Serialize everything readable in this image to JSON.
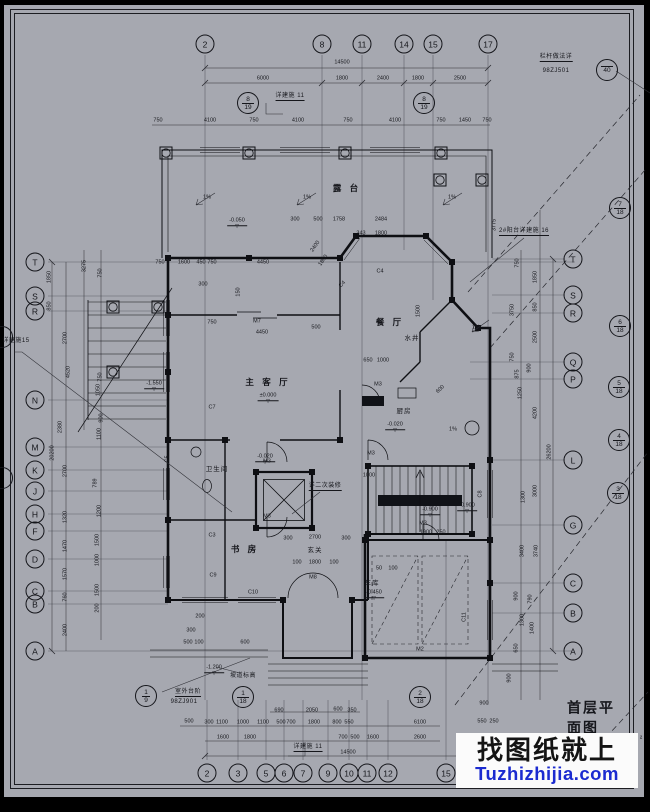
{
  "meta": {
    "sheet_title": "首层平面图",
    "area_fragment": "²",
    "bg_color": "#a6a8b0",
    "ink_color": "#15161b",
    "watermark_blue": "#1b2bd0"
  },
  "watermark": {
    "line1": "找图纸就上",
    "line2": "Tuzhizhijia.com"
  },
  "grid_bubbles": {
    "top": {
      "y": 44,
      "items": [
        {
          "x": 205,
          "label": "2"
        },
        {
          "x": 322,
          "label": "8"
        },
        {
          "x": 362,
          "label": "11"
        },
        {
          "x": 404,
          "label": "14"
        },
        {
          "x": 433,
          "label": "15"
        },
        {
          "x": 488,
          "label": "17"
        }
      ]
    },
    "bottom": {
      "y": 773,
      "items": [
        {
          "x": 207,
          "label": "2"
        },
        {
          "x": 238,
          "label": "3"
        },
        {
          "x": 266,
          "label": "5"
        },
        {
          "x": 284,
          "label": "6"
        },
        {
          "x": 303,
          "label": "7"
        },
        {
          "x": 328,
          "label": "9"
        },
        {
          "x": 349,
          "label": "10"
        },
        {
          "x": 367,
          "label": "11"
        },
        {
          "x": 388,
          "label": "12"
        },
        {
          "x": 446,
          "label": "15"
        }
      ]
    },
    "left": {
      "x": 35,
      "items": [
        {
          "y": 262,
          "label": "T"
        },
        {
          "y": 296,
          "label": "S"
        },
        {
          "y": 311,
          "label": "R"
        },
        {
          "y": 400,
          "label": "N"
        },
        {
          "y": 447,
          "label": "M"
        },
        {
          "y": 470,
          "label": "K"
        },
        {
          "y": 491,
          "label": "J"
        },
        {
          "y": 514,
          "label": "H"
        },
        {
          "y": 531,
          "label": "F"
        },
        {
          "y": 559,
          "label": "D"
        },
        {
          "y": 591,
          "label": "C"
        },
        {
          "y": 604,
          "label": "B"
        },
        {
          "y": 651,
          "label": "A"
        }
      ]
    },
    "right": {
      "x": 573,
      "items": [
        {
          "y": 259,
          "label": "T"
        },
        {
          "y": 295,
          "label": "S"
        },
        {
          "y": 313,
          "label": "R"
        },
        {
          "y": 362,
          "label": "Q"
        },
        {
          "y": 379,
          "label": "P"
        },
        {
          "y": 460,
          "label": "L"
        },
        {
          "y": 525,
          "label": "G"
        },
        {
          "y": 583,
          "label": "C"
        },
        {
          "y": 613,
          "label": "B"
        },
        {
          "y": 651,
          "label": "A"
        }
      ]
    }
  },
  "section_marks": [
    {
      "x": 620,
      "y": 208,
      "label": "7/18"
    },
    {
      "x": 620,
      "y": 326,
      "label": "6/18"
    },
    {
      "x": 619,
      "y": 387,
      "label": "5/18"
    },
    {
      "x": 619,
      "y": 440,
      "label": "4/18"
    },
    {
      "x": 618,
      "y": 493,
      "label": "3/18"
    },
    {
      "x": 146,
      "y": 696,
      "label": "1/9"
    },
    {
      "x": 243,
      "y": 697,
      "label": "1/18"
    },
    {
      "x": 420,
      "y": 697,
      "label": "2/18"
    },
    {
      "x": 248,
      "y": 103,
      "label": "8/19"
    },
    {
      "x": 424,
      "y": 103,
      "label": "8/19"
    },
    {
      "x": 607,
      "y": 70,
      "label": "/40"
    },
    {
      "x": 2,
      "y": 337,
      "label": ""
    },
    {
      "x": 2,
      "y": 478,
      "label": ""
    }
  ],
  "labels": [
    {
      "x": 556,
      "y": 58,
      "t": "栏杆做法详",
      "c": "nu"
    },
    {
      "x": 556,
      "y": 71,
      "t": "98ZJ501",
      "c": "note"
    },
    {
      "x": 290,
      "y": 97,
      "t": "详建施 11",
      "c": "nu"
    },
    {
      "x": 524,
      "y": 232,
      "t": "2#阳台详建施 16",
      "c": "nu"
    },
    {
      "x": 16,
      "y": 341,
      "t": "详建施15",
      "c": "note"
    },
    {
      "x": 325,
      "y": 487,
      "t": "详二次装修",
      "c": "nu"
    },
    {
      "x": 188,
      "y": 693,
      "t": "室外台阶",
      "c": "nu"
    },
    {
      "x": 184,
      "y": 702,
      "t": "98ZJ901",
      "c": "note"
    },
    {
      "x": 243,
      "y": 676,
      "t": "坡道标高",
      "c": "note"
    },
    {
      "x": 308,
      "y": 748,
      "t": "详建施 11",
      "c": "nu"
    },
    {
      "x": 347,
      "y": 188,
      "t": "露 台",
      "c": "room"
    },
    {
      "x": 268,
      "y": 382,
      "t": "主 客 厅",
      "c": "room"
    },
    {
      "x": 390,
      "y": 322,
      "t": "餐 厅",
      "c": "room"
    },
    {
      "x": 245,
      "y": 549,
      "t": "书 房",
      "c": "room"
    },
    {
      "x": 315,
      "y": 551,
      "t": "玄关",
      "c": "rs"
    },
    {
      "x": 217,
      "y": 470,
      "t": "卫生间",
      "c": "rs"
    },
    {
      "x": 372,
      "y": 584,
      "t": "车库",
      "c": "rs"
    },
    {
      "x": 404,
      "y": 412,
      "t": "厨房",
      "c": "rs"
    },
    {
      "x": 412,
      "y": 339,
      "t": "水井",
      "c": "rs"
    },
    {
      "x": 268,
      "y": 397,
      "t": "±0.000",
      "c": "elev"
    },
    {
      "x": 237,
      "y": 222,
      "t": "-0.050",
      "c": "elev"
    },
    {
      "x": 265,
      "y": 458,
      "t": "-0.020",
      "c": "elev"
    },
    {
      "x": 395,
      "y": 426,
      "t": "-0.020",
      "c": "elev"
    },
    {
      "x": 430,
      "y": 511,
      "t": "-0.900",
      "c": "elev"
    },
    {
      "x": 467,
      "y": 507,
      "t": "-0.900",
      "c": "elev"
    },
    {
      "x": 154,
      "y": 385,
      "t": "-1.550",
      "c": "elev"
    },
    {
      "x": 214,
      "y": 669,
      "t": "-1.200",
      "c": "elev"
    },
    {
      "x": 374,
      "y": 594,
      "t": "-0.450",
      "c": "elev"
    },
    {
      "x": 257,
      "y": 322,
      "t": "M7",
      "c": "tag"
    },
    {
      "x": 378,
      "y": 385,
      "t": "M3",
      "c": "tag"
    },
    {
      "x": 371,
      "y": 454,
      "t": "M3",
      "c": "tag"
    },
    {
      "x": 267,
      "y": 462,
      "t": "M3",
      "c": "tag"
    },
    {
      "x": 267,
      "y": 517,
      "t": "M3",
      "c": "tag"
    },
    {
      "x": 423,
      "y": 524,
      "t": "M3",
      "c": "tag"
    },
    {
      "x": 313,
      "y": 578,
      "t": "M8",
      "c": "tag"
    },
    {
      "x": 420,
      "y": 650,
      "t": "M2",
      "c": "tag"
    },
    {
      "x": 343,
      "y": 285,
      "t": "C4",
      "c": "tag",
      "r": -45
    },
    {
      "x": 380,
      "y": 272,
      "t": "C4",
      "c": "tag"
    },
    {
      "x": 212,
      "y": 408,
      "t": "C7",
      "c": "tag"
    },
    {
      "x": 168,
      "y": 459,
      "t": "C5",
      "c": "tag",
      "r": -90
    },
    {
      "x": 212,
      "y": 536,
      "t": "C3",
      "c": "tag"
    },
    {
      "x": 481,
      "y": 494,
      "t": "C8",
      "c": "tag",
      "r": -90
    },
    {
      "x": 213,
      "y": 576,
      "t": "C9",
      "c": "tag"
    },
    {
      "x": 253,
      "y": 593,
      "t": "C10",
      "c": "tag"
    },
    {
      "x": 465,
      "y": 617,
      "t": "C11",
      "c": "tag",
      "r": -90
    },
    {
      "x": 342,
      "y": 63,
      "t": "14500",
      "c": "d"
    },
    {
      "x": 263,
      "y": 79,
      "t": "6000",
      "c": "d"
    },
    {
      "x": 342,
      "y": 79,
      "t": "1800",
      "c": "d"
    },
    {
      "x": 383,
      "y": 79,
      "t": "2400",
      "c": "d"
    },
    {
      "x": 418,
      "y": 79,
      "t": "1800",
      "c": "d"
    },
    {
      "x": 460,
      "y": 79,
      "t": "2500",
      "c": "d"
    },
    {
      "x": 158,
      "y": 121,
      "t": "750",
      "c": "d"
    },
    {
      "x": 210,
      "y": 121,
      "t": "4100",
      "c": "d"
    },
    {
      "x": 254,
      "y": 121,
      "t": "750",
      "c": "d"
    },
    {
      "x": 298,
      "y": 121,
      "t": "4100",
      "c": "d"
    },
    {
      "x": 348,
      "y": 121,
      "t": "750",
      "c": "d"
    },
    {
      "x": 395,
      "y": 121,
      "t": "4100",
      "c": "d"
    },
    {
      "x": 441,
      "y": 121,
      "t": "750",
      "c": "d"
    },
    {
      "x": 465,
      "y": 121,
      "t": "1450",
      "c": "d"
    },
    {
      "x": 487,
      "y": 121,
      "t": "750",
      "c": "d"
    },
    {
      "x": 295,
      "y": 220,
      "t": "300",
      "c": "d"
    },
    {
      "x": 318,
      "y": 220,
      "t": "500",
      "c": "d"
    },
    {
      "x": 339,
      "y": 220,
      "t": "1758",
      "c": "d"
    },
    {
      "x": 381,
      "y": 220,
      "t": "2484",
      "c": "d"
    },
    {
      "x": 361,
      "y": 234,
      "t": "343",
      "c": "d"
    },
    {
      "x": 381,
      "y": 234,
      "t": "1800",
      "c": "d"
    },
    {
      "x": 316,
      "y": 247,
      "t": "2400",
      "c": "d",
      "r": -55
    },
    {
      "x": 324,
      "y": 261,
      "t": "1800",
      "c": "d",
      "r": -55
    },
    {
      "x": 207,
      "y": 198,
      "t": "1%",
      "c": "d"
    },
    {
      "x": 307,
      "y": 198,
      "t": "1%",
      "c": "d"
    },
    {
      "x": 452,
      "y": 198,
      "t": "1%",
      "c": "d"
    },
    {
      "x": 476,
      "y": 328,
      "t": "1%",
      "c": "d"
    },
    {
      "x": 453,
      "y": 430,
      "t": "1%",
      "c": "d"
    },
    {
      "x": 160,
      "y": 263,
      "t": "750",
      "c": "d"
    },
    {
      "x": 184,
      "y": 263,
      "t": "1600",
      "c": "d"
    },
    {
      "x": 201,
      "y": 263,
      "t": "450",
      "c": "d"
    },
    {
      "x": 212,
      "y": 263,
      "t": "750",
      "c": "d"
    },
    {
      "x": 263,
      "y": 263,
      "t": "4450",
      "c": "d"
    },
    {
      "x": 203,
      "y": 285,
      "t": "300",
      "c": "d"
    },
    {
      "x": 239,
      "y": 292,
      "t": "150",
      "c": "d",
      "r": -90
    },
    {
      "x": 212,
      "y": 323,
      "t": "750",
      "c": "d"
    },
    {
      "x": 262,
      "y": 333,
      "t": "4450",
      "c": "d"
    },
    {
      "x": 316,
      "y": 328,
      "t": "500",
      "c": "d"
    },
    {
      "x": 368,
      "y": 361,
      "t": "650",
      "c": "d"
    },
    {
      "x": 383,
      "y": 361,
      "t": "1000",
      "c": "d"
    },
    {
      "x": 419,
      "y": 311,
      "t": "1500",
      "c": "d",
      "r": -90
    },
    {
      "x": 441,
      "y": 390,
      "t": "600",
      "c": "d",
      "r": -45
    },
    {
      "x": 288,
      "y": 539,
      "t": "300",
      "c": "d"
    },
    {
      "x": 315,
      "y": 538,
      "t": "2700",
      "c": "d"
    },
    {
      "x": 346,
      "y": 539,
      "t": "300",
      "c": "d"
    },
    {
      "x": 297,
      "y": 563,
      "t": "100",
      "c": "d"
    },
    {
      "x": 315,
      "y": 563,
      "t": "1800",
      "c": "d"
    },
    {
      "x": 334,
      "y": 563,
      "t": "100",
      "c": "d"
    },
    {
      "x": 369,
      "y": 476,
      "t": "1000",
      "c": "d"
    },
    {
      "x": 426,
      "y": 533,
      "t": "1900",
      "c": "d"
    },
    {
      "x": 441,
      "y": 533,
      "t": "250",
      "c": "d"
    },
    {
      "x": 379,
      "y": 569,
      "t": "50",
      "c": "d"
    },
    {
      "x": 393,
      "y": 569,
      "t": "100",
      "c": "d"
    },
    {
      "x": 200,
      "y": 617,
      "t": "200",
      "c": "d"
    },
    {
      "x": 191,
      "y": 631,
      "t": "300",
      "c": "d"
    },
    {
      "x": 279,
      "y": 711,
      "t": "690",
      "c": "d"
    },
    {
      "x": 312,
      "y": 711,
      "t": "2050",
      "c": "d"
    },
    {
      "x": 338,
      "y": 710,
      "t": "600",
      "c": "d"
    },
    {
      "x": 352,
      "y": 711,
      "t": "350",
      "c": "d"
    },
    {
      "x": 189,
      "y": 722,
      "t": "500",
      "c": "d"
    },
    {
      "x": 209,
      "y": 723,
      "t": "300",
      "c": "d"
    },
    {
      "x": 222,
      "y": 723,
      "t": "1100",
      "c": "d"
    },
    {
      "x": 243,
      "y": 723,
      "t": "1000",
      "c": "d"
    },
    {
      "x": 263,
      "y": 723,
      "t": "1100",
      "c": "d"
    },
    {
      "x": 281,
      "y": 723,
      "t": "500",
      "c": "d"
    },
    {
      "x": 291,
      "y": 723,
      "t": "700",
      "c": "d"
    },
    {
      "x": 314,
      "y": 723,
      "t": "1800",
      "c": "d"
    },
    {
      "x": 337,
      "y": 723,
      "t": "800",
      "c": "d"
    },
    {
      "x": 349,
      "y": 723,
      "t": "550",
      "c": "d"
    },
    {
      "x": 420,
      "y": 723,
      "t": "6100",
      "c": "d"
    },
    {
      "x": 223,
      "y": 738,
      "t": "1600",
      "c": "d"
    },
    {
      "x": 250,
      "y": 738,
      "t": "1800",
      "c": "d"
    },
    {
      "x": 343,
      "y": 738,
      "t": "700",
      "c": "d"
    },
    {
      "x": 355,
      "y": 738,
      "t": "500",
      "c": "d"
    },
    {
      "x": 373,
      "y": 738,
      "t": "1600",
      "c": "d"
    },
    {
      "x": 420,
      "y": 738,
      "t": "2600",
      "c": "d"
    },
    {
      "x": 348,
      "y": 753,
      "t": "14500",
      "c": "d"
    },
    {
      "x": 188,
      "y": 643,
      "t": "500",
      "c": "d"
    },
    {
      "x": 199,
      "y": 643,
      "t": "100",
      "c": "d"
    },
    {
      "x": 245,
      "y": 643,
      "t": "600",
      "c": "d"
    },
    {
      "x": 484,
      "y": 704,
      "t": "900",
      "c": "d"
    },
    {
      "x": 482,
      "y": 722,
      "t": "550",
      "c": "d"
    },
    {
      "x": 494,
      "y": 722,
      "t": "250",
      "c": "d"
    },
    {
      "x": 85,
      "y": 266,
      "t": "3275",
      "c": "d",
      "r": -90
    },
    {
      "x": 50,
      "y": 277,
      "t": "1850",
      "c": "d",
      "r": -90
    },
    {
      "x": 50,
      "y": 306,
      "t": "850",
      "c": "d",
      "r": -90
    },
    {
      "x": 66,
      "y": 338,
      "t": "2700",
      "c": "d",
      "r": -90
    },
    {
      "x": 69,
      "y": 372,
      "t": "4520",
      "c": "d",
      "r": -90
    },
    {
      "x": 101,
      "y": 273,
      "t": "750",
      "c": "d",
      "r": -90
    },
    {
      "x": 101,
      "y": 377,
      "t": "750",
      "c": "d",
      "r": -90
    },
    {
      "x": 99,
      "y": 390,
      "t": "1050",
      "c": "d",
      "r": -90
    },
    {
      "x": 102,
      "y": 418,
      "t": "900",
      "c": "d",
      "r": -90
    },
    {
      "x": 100,
      "y": 434,
      "t": "1100",
      "c": "d",
      "r": -90
    },
    {
      "x": 61,
      "y": 427,
      "t": "2380",
      "c": "d",
      "r": -90
    },
    {
      "x": 53,
      "y": 453,
      "t": "20200",
      "c": "d",
      "r": -90
    },
    {
      "x": 66,
      "y": 471,
      "t": "2700",
      "c": "d",
      "r": -90
    },
    {
      "x": 96,
      "y": 483,
      "t": "789",
      "c": "d",
      "r": -90
    },
    {
      "x": 100,
      "y": 511,
      "t": "1200",
      "c": "d",
      "r": -90
    },
    {
      "x": 66,
      "y": 517,
      "t": "1320",
      "c": "d",
      "r": -90
    },
    {
      "x": 98,
      "y": 540,
      "t": "1500",
      "c": "d",
      "r": -90
    },
    {
      "x": 66,
      "y": 546,
      "t": "1470",
      "c": "d",
      "r": -90
    },
    {
      "x": 98,
      "y": 560,
      "t": "1000",
      "c": "d",
      "r": -90
    },
    {
      "x": 66,
      "y": 574,
      "t": "1570",
      "c": "d",
      "r": -90
    },
    {
      "x": 98,
      "y": 590,
      "t": "1500",
      "c": "d",
      "r": -90
    },
    {
      "x": 66,
      "y": 597,
      "t": "760",
      "c": "d",
      "r": -90
    },
    {
      "x": 98,
      "y": 608,
      "t": "200",
      "c": "d",
      "r": -90
    },
    {
      "x": 66,
      "y": 630,
      "t": "2400",
      "c": "d",
      "r": -90
    },
    {
      "x": 495,
      "y": 225,
      "t": "3775",
      "c": "d",
      "r": -90
    },
    {
      "x": 518,
      "y": 263,
      "t": "750",
      "c": "d",
      "r": -90
    },
    {
      "x": 536,
      "y": 277,
      "t": "1850",
      "c": "d",
      "r": -90
    },
    {
      "x": 536,
      "y": 307,
      "t": "850",
      "c": "d",
      "r": -90
    },
    {
      "x": 513,
      "y": 310,
      "t": "3750",
      "c": "d",
      "r": -90
    },
    {
      "x": 536,
      "y": 337,
      "t": "2500",
      "c": "d",
      "r": -90
    },
    {
      "x": 513,
      "y": 357,
      "t": "750",
      "c": "d",
      "r": -90
    },
    {
      "x": 530,
      "y": 368,
      "t": "900",
      "c": "d",
      "r": -90
    },
    {
      "x": 518,
      "y": 374,
      "t": "875",
      "c": "d",
      "r": -90
    },
    {
      "x": 521,
      "y": 393,
      "t": "1250",
      "c": "d",
      "r": -90
    },
    {
      "x": 536,
      "y": 413,
      "t": "4200",
      "c": "d",
      "r": -90
    },
    {
      "x": 550,
      "y": 452,
      "t": "26200",
      "c": "d",
      "r": -90
    },
    {
      "x": 536,
      "y": 491,
      "t": "3000",
      "c": "d",
      "r": -90
    },
    {
      "x": 524,
      "y": 497,
      "t": "1300",
      "c": "d",
      "r": -90
    },
    {
      "x": 523,
      "y": 551,
      "t": "3400",
      "c": "d",
      "r": -90
    },
    {
      "x": 537,
      "y": 551,
      "t": "3740",
      "c": "d",
      "r": -90
    },
    {
      "x": 517,
      "y": 596,
      "t": "900",
      "c": "d",
      "r": -90
    },
    {
      "x": 531,
      "y": 599,
      "t": "790",
      "c": "d",
      "r": -90
    },
    {
      "x": 523,
      "y": 620,
      "t": "1300",
      "c": "d",
      "r": -90
    },
    {
      "x": 533,
      "y": 628,
      "t": "1400",
      "c": "d",
      "r": -90
    },
    {
      "x": 517,
      "y": 648,
      "t": "650",
      "c": "d",
      "r": -90
    },
    {
      "x": 510,
      "y": 678,
      "t": "900",
      "c": "d",
      "r": -90
    }
  ]
}
